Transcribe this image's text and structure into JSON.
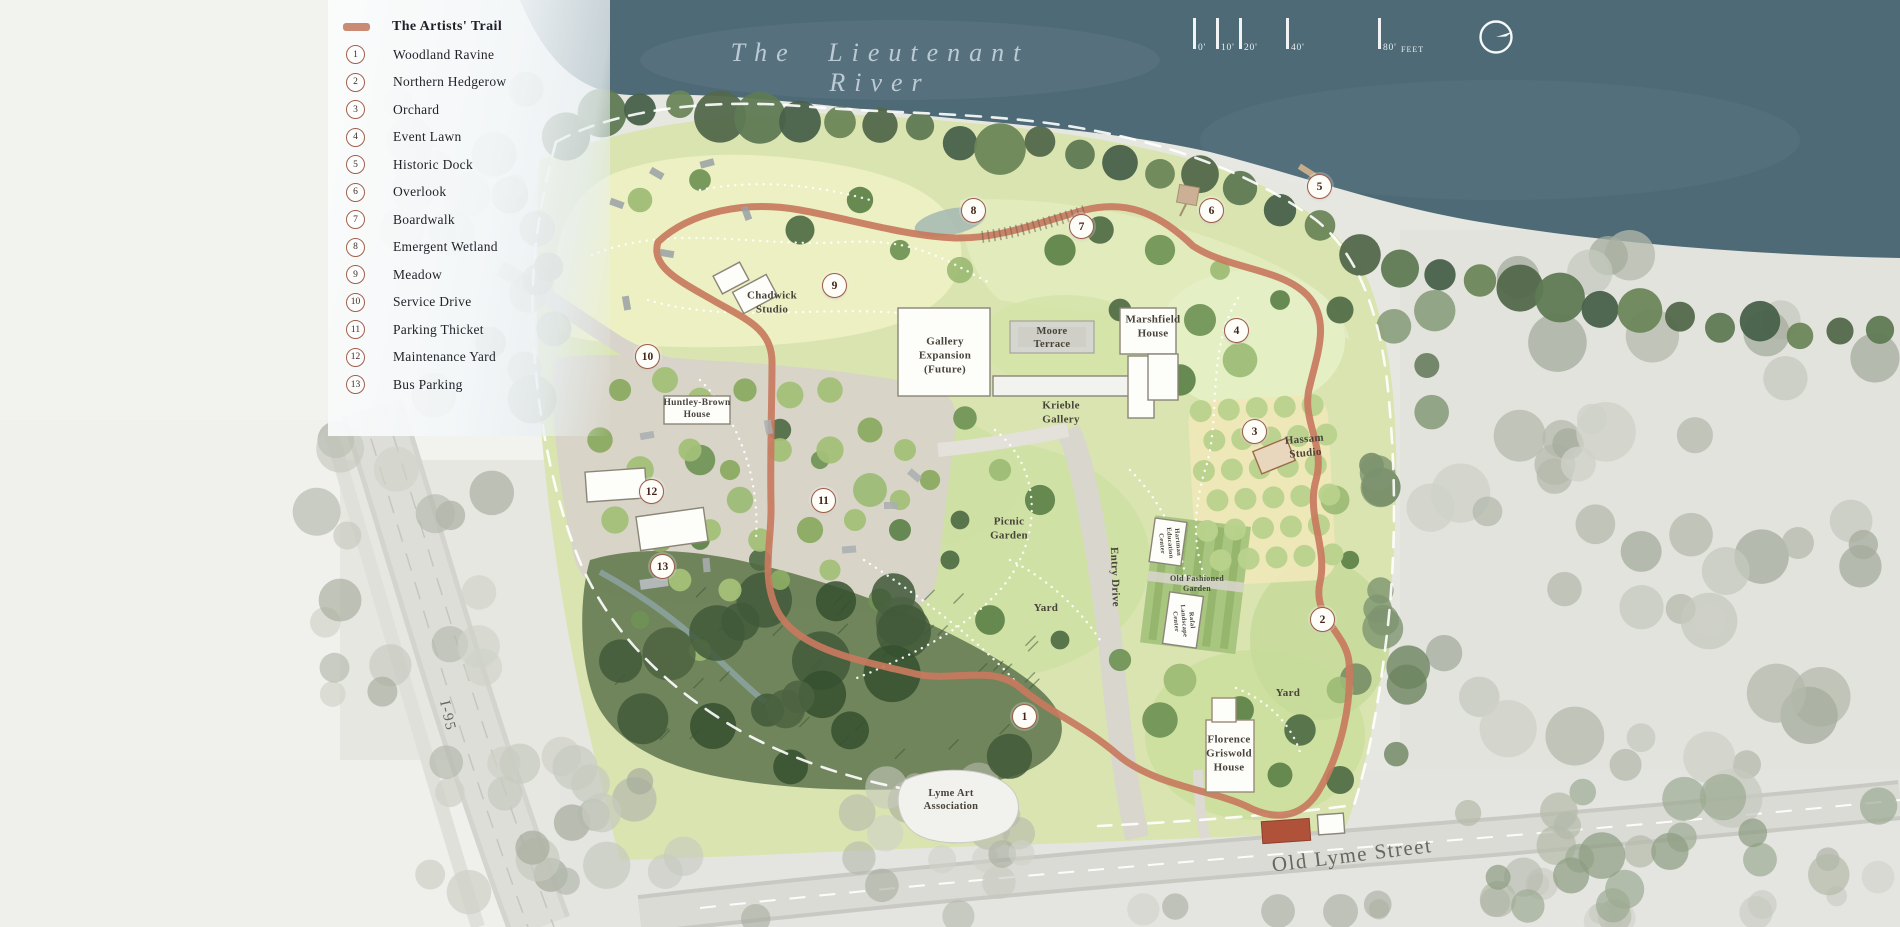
{
  "river_title": "The Lieutenant River",
  "legend": {
    "trail_label": "The Artists' Trail",
    "items": [
      {
        "num": "1",
        "label": "Woodland Ravine"
      },
      {
        "num": "2",
        "label": "Northern Hedgerow"
      },
      {
        "num": "3",
        "label": "Orchard"
      },
      {
        "num": "4",
        "label": "Event Lawn"
      },
      {
        "num": "5",
        "label": "Historic Dock"
      },
      {
        "num": "6",
        "label": "Overlook"
      },
      {
        "num": "7",
        "label": "Boardwalk"
      },
      {
        "num": "8",
        "label": "Emergent Wetland"
      },
      {
        "num": "9",
        "label": "Meadow"
      },
      {
        "num": "10",
        "label": "Service Drive"
      },
      {
        "num": "11",
        "label": "Parking Thicket"
      },
      {
        "num": "12",
        "label": "Maintenance Yard"
      },
      {
        "num": "13",
        "label": "Bus Parking"
      }
    ]
  },
  "scale_bar": {
    "ticks": [
      {
        "label": "0'",
        "x": 8
      },
      {
        "label": "10'",
        "x": 31
      },
      {
        "label": "20'",
        "x": 54
      },
      {
        "label": "40'",
        "x": 101
      },
      {
        "label": "80'",
        "x": 193
      }
    ],
    "unit": "FEET"
  },
  "map": {
    "markers": [
      {
        "num": "1",
        "x": 1025,
        "y": 717
      },
      {
        "num": "2",
        "x": 1323,
        "y": 620
      },
      {
        "num": "3",
        "x": 1255,
        "y": 432
      },
      {
        "num": "4",
        "x": 1237,
        "y": 331
      },
      {
        "num": "5",
        "x": 1320,
        "y": 187
      },
      {
        "num": "6",
        "x": 1212,
        "y": 211
      },
      {
        "num": "7",
        "x": 1082,
        "y": 227
      },
      {
        "num": "8",
        "x": 974,
        "y": 211
      },
      {
        "num": "9",
        "x": 835,
        "y": 286
      },
      {
        "num": "10",
        "x": 648,
        "y": 357
      },
      {
        "num": "11",
        "x": 824,
        "y": 501
      },
      {
        "num": "12",
        "x": 652,
        "y": 492
      },
      {
        "num": "13",
        "x": 663,
        "y": 567
      }
    ],
    "labels": [
      {
        "id": "chadwick-studio",
        "text": "Chadwick\nStudio",
        "x": 772,
        "y": 303,
        "size": 11,
        "rot": 0,
        "kind": "place"
      },
      {
        "id": "gallery-expansion-future",
        "text": "Gallery\nExpansion\n(Future)",
        "x": 945,
        "y": 356,
        "size": 11,
        "rot": 0,
        "kind": "place"
      },
      {
        "id": "moore-terrace",
        "text": "Moore\nTerrace",
        "x": 1052,
        "y": 338,
        "size": 10.5,
        "rot": 0,
        "kind": "place"
      },
      {
        "id": "marshfield-house",
        "text": "Marshfield\nHouse",
        "x": 1153,
        "y": 327,
        "size": 11,
        "rot": 0,
        "kind": "place"
      },
      {
        "id": "krieble-gallery",
        "text": "Krieble\nGallery",
        "x": 1061,
        "y": 413,
        "size": 11,
        "rot": 0,
        "kind": "place"
      },
      {
        "id": "hassam-studio",
        "text": "Hassam\nStudio",
        "x": 1305,
        "y": 447,
        "size": 11,
        "rot": -5,
        "kind": "place"
      },
      {
        "id": "huntley-brown-house",
        "text": "Huntley-Brown\nHouse",
        "x": 697,
        "y": 410,
        "size": 9.5,
        "rot": 0,
        "kind": "place"
      },
      {
        "id": "picnic-garden",
        "text": "Picnic\nGarden",
        "x": 1009,
        "y": 529,
        "size": 11,
        "rot": 0,
        "kind": "place"
      },
      {
        "id": "entry-drive",
        "text": "Entry Drive",
        "x": 1114,
        "y": 577,
        "size": 11,
        "rot": 88,
        "kind": "place"
      },
      {
        "id": "yard-west",
        "text": "Yard",
        "x": 1046,
        "y": 609,
        "size": 11,
        "rot": 0,
        "kind": "place"
      },
      {
        "id": "yard-east",
        "text": "Yard",
        "x": 1288,
        "y": 694,
        "size": 11,
        "rot": 0,
        "kind": "place"
      },
      {
        "id": "old-fashioned-garden",
        "text": "Old Fashioned\nGarden",
        "x": 1197,
        "y": 584,
        "size": 8,
        "rot": 0,
        "kind": "garden"
      },
      {
        "id": "hartman-education-center",
        "text": "Hartman\nEducation\nCenter",
        "x": 1169,
        "y": 543,
        "size": 6.5,
        "rot": 85,
        "kind": "place"
      },
      {
        "id": "rafal-landscape-center",
        "text": "Rafal\nLandscape\nCenter",
        "x": 1183,
        "y": 621,
        "size": 6.5,
        "rot": 85,
        "kind": "place"
      },
      {
        "id": "florence-griswold-house",
        "text": "Florence\nGriswold\nHouse",
        "x": 1229,
        "y": 754,
        "size": 11,
        "rot": 0,
        "kind": "place"
      },
      {
        "id": "lyme-art-association",
        "text": "Lyme Art\nAssociation",
        "x": 951,
        "y": 800,
        "size": 10.5,
        "rot": 0,
        "kind": "place"
      },
      {
        "id": "old-lyme-street",
        "text": "Old Lyme Street",
        "x": 1352,
        "y": 855,
        "size": 21,
        "rot": -7,
        "kind": "road"
      },
      {
        "id": "i-95",
        "text": "I-95",
        "x": 447,
        "y": 716,
        "size": 15,
        "rot": 77,
        "kind": "road"
      }
    ]
  },
  "colors": {
    "trail": "#c87a5e",
    "marker_ring": "#9d5c48",
    "river": "#4d6a76",
    "meadow": "#edf0c4",
    "lawn": "#d9e4b0",
    "woodland": "#6a8056",
    "parking": "#d8d3c9",
    "boundary_dash": "#ffffff"
  }
}
